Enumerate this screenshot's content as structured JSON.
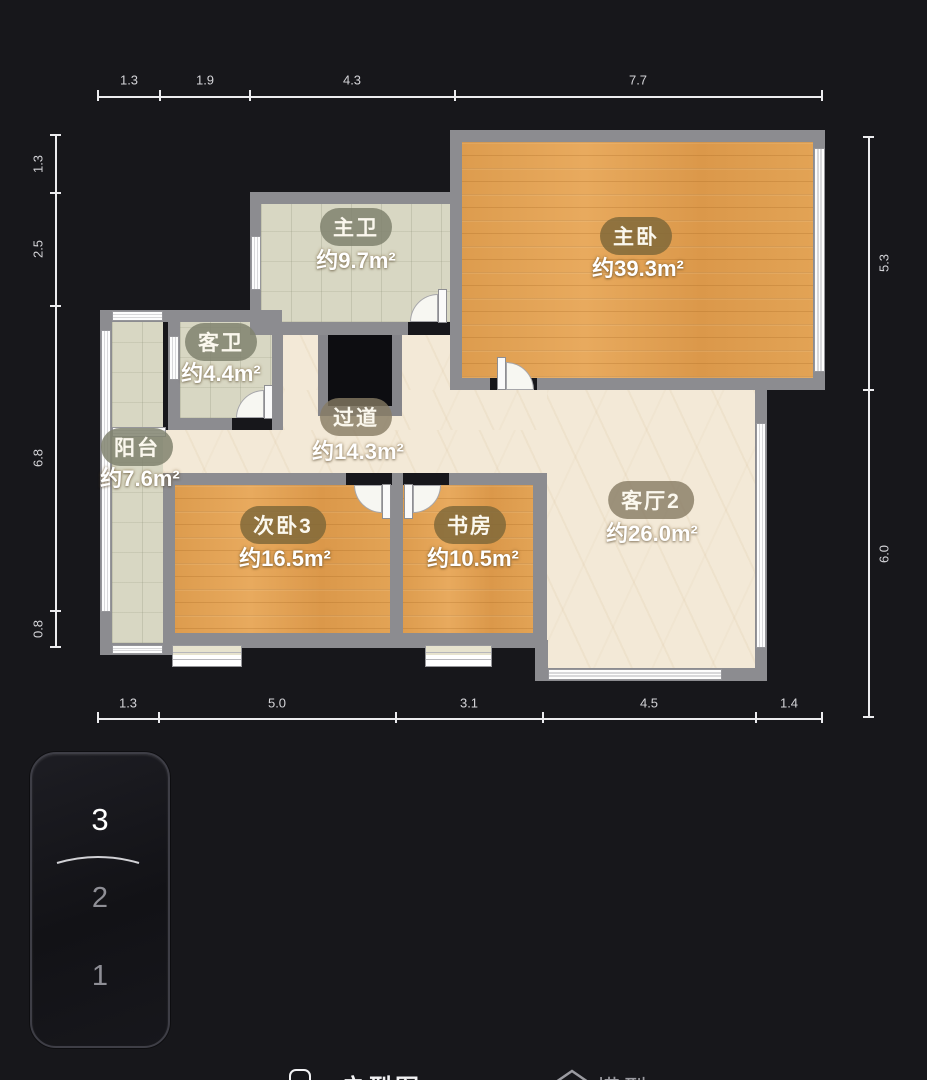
{
  "app": {
    "view_title": "floor-plan-viewer"
  },
  "dims": {
    "top": [
      "1.3",
      "1.9",
      "4.3",
      "7.7"
    ],
    "bottom": [
      "1.3",
      "5.0",
      "3.1",
      "4.5",
      "1.4"
    ],
    "left": [
      "1.3",
      "2.5",
      "6.8",
      "0.8"
    ],
    "right": [
      "5.3",
      "6.0"
    ]
  },
  "rooms": {
    "master_bath": {
      "name": "主卫",
      "area": "约9.7m²"
    },
    "master_bed": {
      "name": "主卧",
      "area": "约39.3m²"
    },
    "guest_bath": {
      "name": "客卫",
      "area": "约4.4m²"
    },
    "balcony": {
      "name": "阳台",
      "area": "约7.6m²"
    },
    "hallway": {
      "name": "过道",
      "area": "约14.3m²"
    },
    "bed3": {
      "name": "次卧3",
      "area": "约16.5m²"
    },
    "study": {
      "name": "书房",
      "area": "约10.5m²"
    },
    "living2": {
      "name": "客厅2",
      "area": "约26.0m²"
    }
  },
  "floor_selector": {
    "floors": [
      "3",
      "2",
      "1"
    ],
    "selected": "3"
  },
  "bottom_bar": {
    "left_tab": "户型图",
    "right_tab": "模型"
  },
  "colors": {
    "background": "#17171b",
    "wall": "#8c8c90",
    "wood_floor": "#e1a254",
    "tile_floor": "#d8d7c3",
    "marble_floor": "#f3e9d7",
    "dimension_text": "#d4d4d8",
    "selected_floor_text": "#ffffff",
    "unselected_floor_text": "#8f8f96"
  }
}
